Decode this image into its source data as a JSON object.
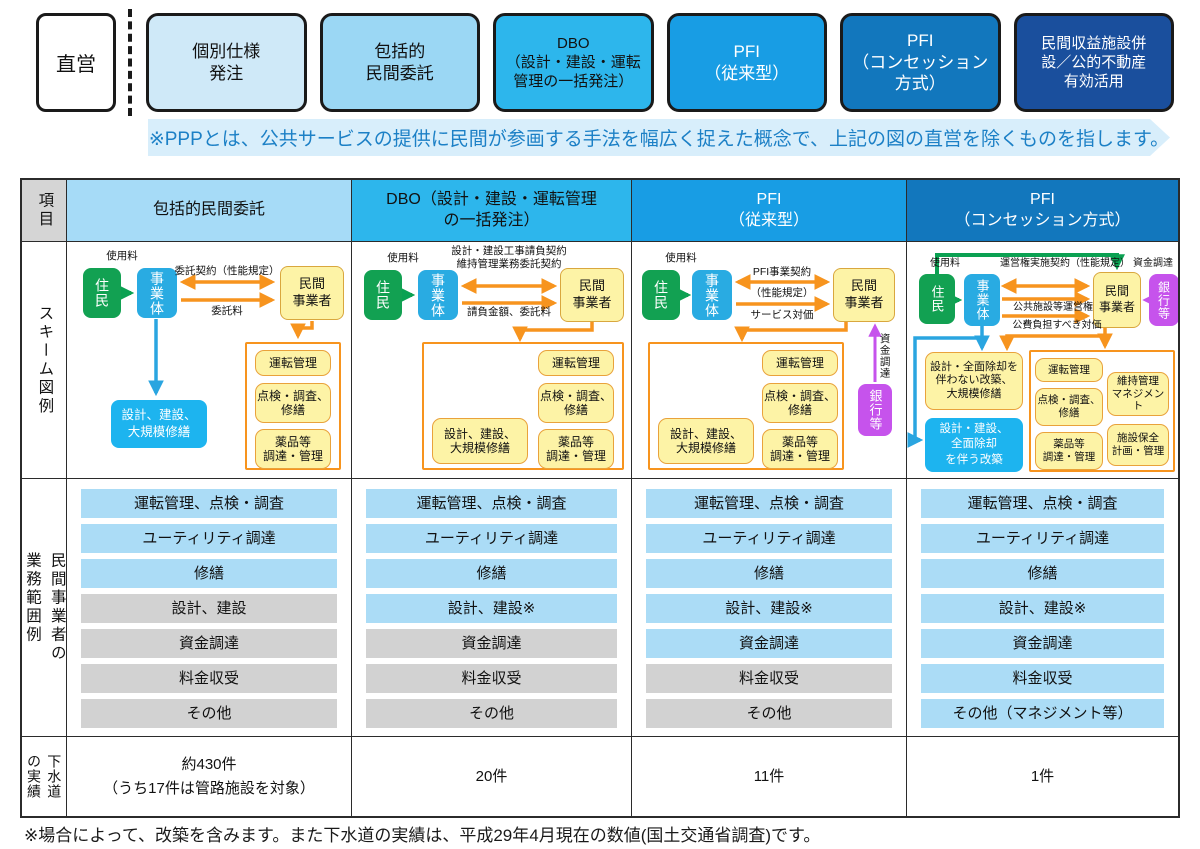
{
  "top": {
    "direct_label": "直営",
    "ppp_boxes": [
      {
        "label": "個別仕様\n発注",
        "bg": "#cfe9f8",
        "fg": "#111111"
      },
      {
        "label": "包括的\n民間委託",
        "bg": "#9bd7f4",
        "fg": "#111111"
      },
      {
        "label": "DBO\n（設計・建設・運転\n管理の一括発注）",
        "bg": "#2db6ec",
        "fg": "#111111"
      },
      {
        "label": "PFI\n（従来型）",
        "bg": "#189de4",
        "fg": "#ffffff"
      },
      {
        "label": "PFI\n（コンセッション\n方式）",
        "bg": "#1277bd",
        "fg": "#ffffff"
      },
      {
        "label": "民間収益施設併\n設／公的不動産\n有効活用",
        "bg": "#1a4f9d",
        "fg": "#ffffff"
      }
    ],
    "ppp_note": "※PPPとは、公共サービスの提供に民間が参画する手法を幅広く捉えた概念で、上記の図の直営を除くものを指します。"
  },
  "table": {
    "item_header": "項目",
    "col_headers": [
      {
        "label": "包括的民間委託",
        "bg": "#a6dbf7",
        "fg": "#111111"
      },
      {
        "label": "DBO（設計・建設・運転管理\nの一括発注）",
        "bg": "#2db6ec",
        "fg": "#111111"
      },
      {
        "label": "PFI\n（従来型）",
        "bg": "#189de4",
        "fg": "#ffffff"
      },
      {
        "label": "PFI\n（コンセッション方式）",
        "bg": "#1277bd",
        "fg": "#ffffff"
      }
    ],
    "row_labels": {
      "scheme": "スキーム図例",
      "scope": "民間事業者の\n業務範囲例",
      "results": "下水道\nの実績"
    }
  },
  "schemes": {
    "c1": {
      "resident": "住民",
      "operator": "事業体",
      "private": "民間\n事業者",
      "fee": "使用料",
      "contract": "委託契約（性能規定）",
      "payment": "委託料",
      "t1": "運転管理",
      "t2": "点検・調査、\n修繕",
      "t3": "薬品等\n調達・管理",
      "public_box": "設計、建設、\n大規模修繕"
    },
    "c2": {
      "resident": "住民",
      "operator": "事業体",
      "private": "民間\n事業者",
      "fee": "使用料",
      "contract": "設計・建設工事請負契約\n維持管理業務委託契約",
      "payment": "請負金額、委託料",
      "t1": "運転管理",
      "t2": "点検・調査、\n修繕",
      "t3": "薬品等\n調達・管理",
      "design_box": "設計、建設、\n大規模修繕"
    },
    "c3": {
      "resident": "住民",
      "operator": "事業体",
      "private": "民間\n事業者",
      "fee": "使用料",
      "contract": "PFI事業契約",
      "spec": "（性能規定）",
      "payment": "サービス対価",
      "bank": "銀行等",
      "finance": "資金調達",
      "t1": "運転管理",
      "t2": "点検・調査、\n修繕",
      "t3": "薬品等\n調達・管理",
      "design_box": "設計、建設、\n大規模修繕"
    },
    "c4": {
      "resident": "住民",
      "operator": "事業体",
      "private": "民間\n事業者",
      "bank": "銀行等",
      "fee": "使用料",
      "contract": "運営権実施契約（性能規定）",
      "finance": "資金調達",
      "right": "公共施設等運営権",
      "price": "公費負担すべき対価",
      "rebuild_no": "設計・全面除却を\n伴わない改築、\n大規模修繕",
      "rebuild_yes": "設計・建設、\n全面除却\nを伴う改築",
      "t1": "運転管理",
      "t2": "点検・調査、\n修繕",
      "t3": "薬品等\n調達・管理",
      "m1": "維持管理\nマネジメント",
      "m2": "施設保全\n計画・管理"
    }
  },
  "scope": {
    "columns": [
      {
        "items": [
          {
            "label": "運転管理、点検・調査",
            "on": true
          },
          {
            "label": "ユーティリティ調達",
            "on": true
          },
          {
            "label": "修繕",
            "on": true
          },
          {
            "label": "設計、建設",
            "on": false
          },
          {
            "label": "資金調達",
            "on": false
          },
          {
            "label": "料金収受",
            "on": false
          },
          {
            "label": "その他",
            "on": false
          }
        ]
      },
      {
        "items": [
          {
            "label": "運転管理、点検・調査",
            "on": true
          },
          {
            "label": "ユーティリティ調達",
            "on": true
          },
          {
            "label": "修繕",
            "on": true
          },
          {
            "label": "設計、建設※",
            "on": true
          },
          {
            "label": "資金調達",
            "on": false
          },
          {
            "label": "料金収受",
            "on": false
          },
          {
            "label": "その他",
            "on": false
          }
        ]
      },
      {
        "items": [
          {
            "label": "運転管理、点検・調査",
            "on": true
          },
          {
            "label": "ユーティリティ調達",
            "on": true
          },
          {
            "label": "修繕",
            "on": true
          },
          {
            "label": "設計、建設※",
            "on": true
          },
          {
            "label": "資金調達",
            "on": true
          },
          {
            "label": "料金収受",
            "on": false
          },
          {
            "label": "その他",
            "on": false
          }
        ]
      },
      {
        "items": [
          {
            "label": "運転管理、点検・調査",
            "on": true
          },
          {
            "label": "ユーティリティ調達",
            "on": true
          },
          {
            "label": "修繕",
            "on": true
          },
          {
            "label": "設計、建設※",
            "on": true
          },
          {
            "label": "資金調達",
            "on": true
          },
          {
            "label": "料金収受",
            "on": true
          },
          {
            "label": "その他（マネジメント等）",
            "on": true
          }
        ]
      }
    ]
  },
  "results": {
    "values": [
      "約430件\n（うち17件は管路施設を対象）",
      "20件",
      "11件",
      "1件"
    ]
  },
  "footnote": "※場合によって、改築を含みます。また下水道の実績は、平成29年4月現在の数値(国土交通省調査)です。",
  "colors": {
    "resident_green": "#12a152",
    "operator_cyan": "#29abe2",
    "private_yellow": "#fdf3a6",
    "task_border": "#e9a23b",
    "container_orange": "#f7941e",
    "bank_purple": "#c653ec",
    "blue_box": "#1db4ef",
    "scope_on": "#abdcf6",
    "scope_off": "#d2d2d2",
    "banner_bg": "#d8eefb",
    "banner_text": "#1c80c6"
  }
}
